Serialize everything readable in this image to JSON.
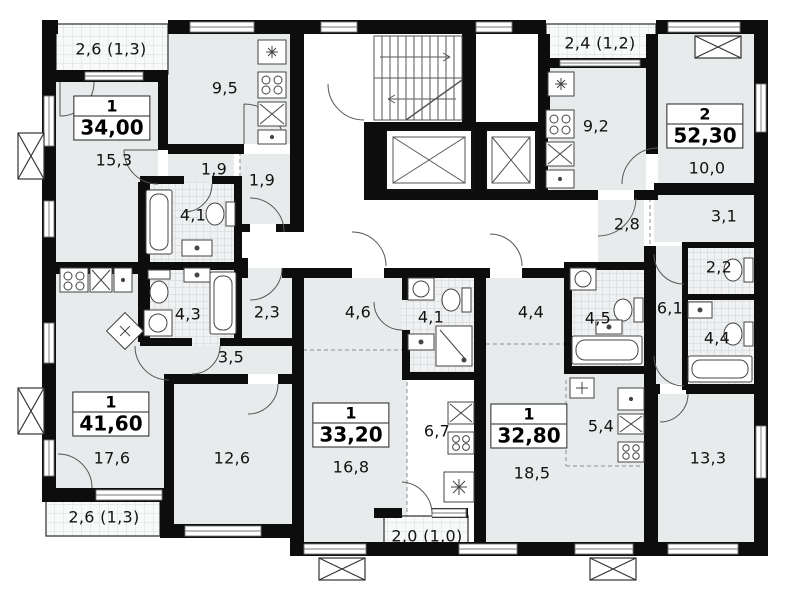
{
  "apartments": [
    {
      "type": "1",
      "total": "34,00",
      "rooms": [
        {
          "name": "living-room",
          "area": "15,3"
        },
        {
          "name": "kitchen",
          "area": "9,5"
        },
        {
          "name": "hall",
          "area": "1,9"
        },
        {
          "name": "hall",
          "area": "1,9"
        },
        {
          "name": "bathroom",
          "area": "4,1"
        },
        {
          "name": "balcony",
          "area": "2,6 (1,3)"
        }
      ]
    },
    {
      "type": "1",
      "total": "41,60",
      "rooms": [
        {
          "name": "living-room",
          "area": "17,6"
        },
        {
          "name": "room",
          "area": "12,6"
        },
        {
          "name": "bathroom",
          "area": "4,3"
        },
        {
          "name": "corridor",
          "area": "3,5"
        },
        {
          "name": "hall",
          "area": "2,3"
        },
        {
          "name": "balcony",
          "area": "2,6 (1,3)"
        }
      ]
    },
    {
      "type": "1",
      "total": "33,20",
      "rooms": [
        {
          "name": "living-room",
          "area": "16,8"
        },
        {
          "name": "kitchen",
          "area": "6,7"
        },
        {
          "name": "hall",
          "area": "4,6"
        },
        {
          "name": "bathroom",
          "area": "4,1"
        },
        {
          "name": "balcony",
          "area": "2,0 (1,0)"
        }
      ]
    },
    {
      "type": "1",
      "total": "32,80",
      "rooms": [
        {
          "name": "living-room",
          "area": "18,5"
        },
        {
          "name": "kitchen",
          "area": "5,4"
        },
        {
          "name": "hall",
          "area": "4,4"
        },
        {
          "name": "bathroom",
          "area": "4,5"
        }
      ]
    },
    {
      "type": "2",
      "total": "52,30",
      "rooms": [
        {
          "name": "kitchen",
          "area": "9,2"
        },
        {
          "name": "room",
          "area": "10,0"
        },
        {
          "name": "hall",
          "area": "2,8"
        },
        {
          "name": "hall",
          "area": "3,1"
        },
        {
          "name": "wc",
          "area": "2,2"
        },
        {
          "name": "corridor",
          "area": "6,1"
        },
        {
          "name": "bathroom",
          "area": "4,4"
        },
        {
          "name": "living-room",
          "area": "13,3"
        },
        {
          "name": "balcony",
          "area": "2,4 (1,2)"
        }
      ]
    }
  ]
}
